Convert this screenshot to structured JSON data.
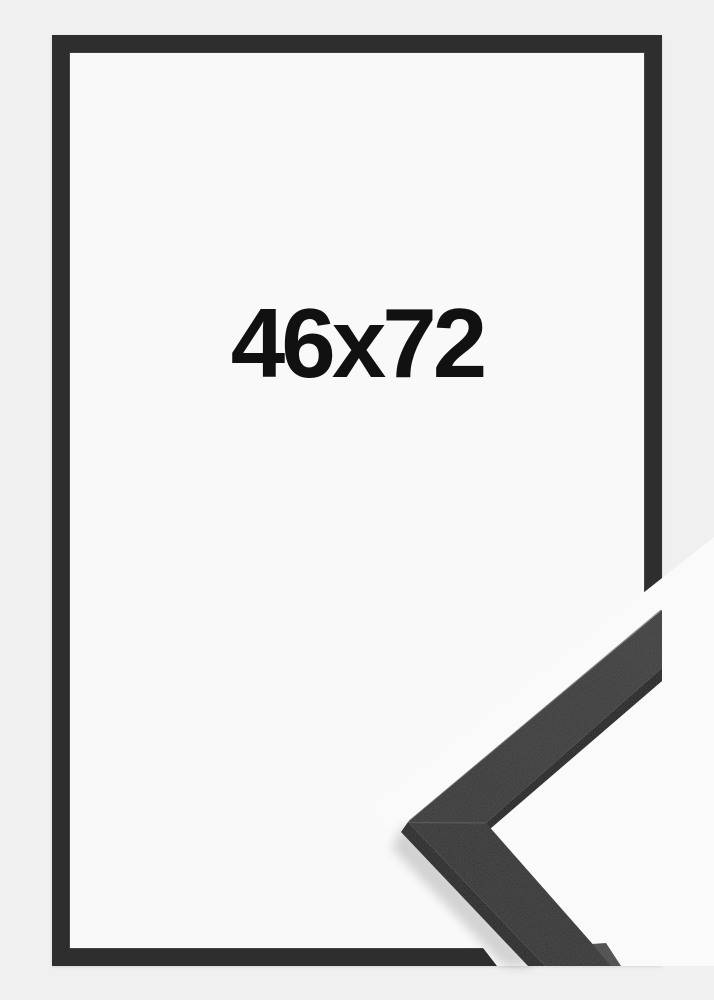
{
  "product": {
    "size_label": "46x72"
  },
  "image": {
    "type": "product-photo",
    "subject": "picture-frame-front-view-with-corner-moulding-sample"
  },
  "colors": {
    "background": "#f0f0f0",
    "photo_background": "#fafafa",
    "frame": "#2e2e2e",
    "frame_inner": "#f9f9f9",
    "label": "#111111",
    "moulding_top": "#383838",
    "moulding_top_2": "#323232",
    "moulding_side": "#242424",
    "moulding_under": "#1c1c1c",
    "moulding_facet": "#4a4a4a",
    "seam": "#515151"
  }
}
